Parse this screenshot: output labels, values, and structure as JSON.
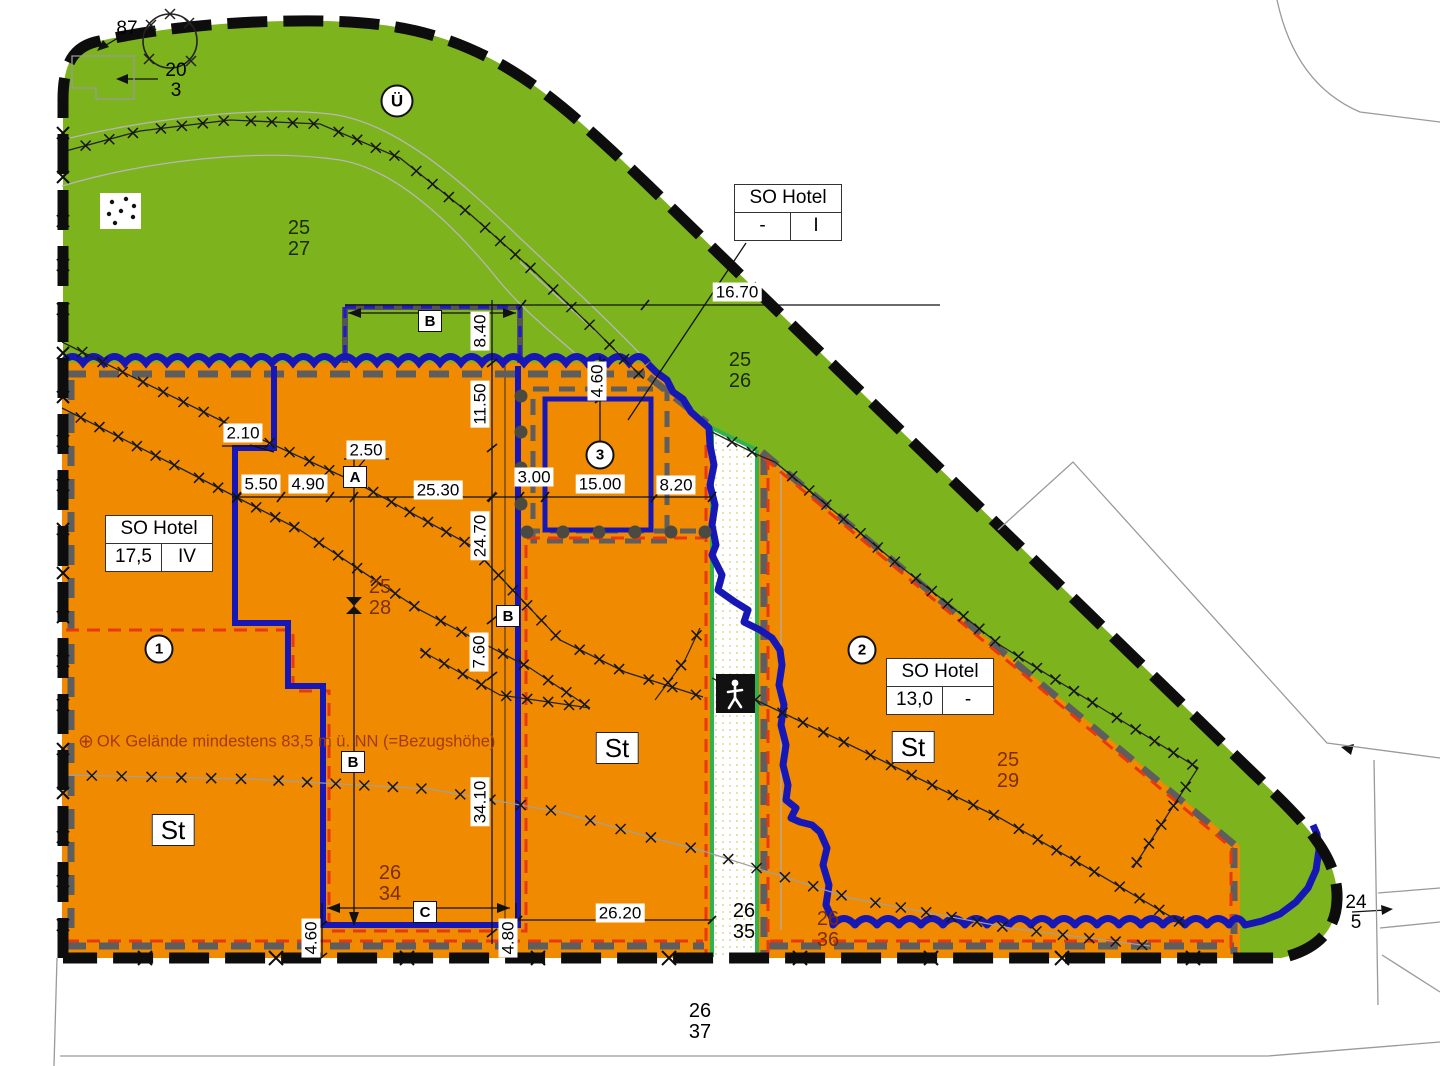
{
  "plan": {
    "type": "Bebauungsplan / zoning site plan",
    "note": {
      "symbol": "⊕",
      "text": "OK Gelände mindestens 83,5 m ü. NN (=Bezugshöhe)"
    },
    "colors": {
      "open_space_green": "#7db31c",
      "building_land_orange": "#f08a00",
      "scope_line_blue": "#1717b5",
      "building_line_red": "#e8380f",
      "boundary_black": "#0d0d0d",
      "dashed_gray": "#5e5e5e",
      "footpath_edge_green": "#2eb34f"
    }
  },
  "tables": {
    "hotel_top": {
      "title": "SO Hotel",
      "left": "-",
      "right": "I"
    },
    "hotel_left": {
      "title": "SO Hotel",
      "left": "17,5",
      "right": "IV"
    },
    "hotel_right": {
      "title": "SO Hotel",
      "left": "13,0",
      "right": "-"
    }
  },
  "dims": {
    "d16_70": "16.70",
    "d8_40": "8.40",
    "d11_50": "11.50",
    "d4_60a": "4.60",
    "d2_10": "2.10",
    "d2_50": "2.50",
    "d5_50": "5.50",
    "d4_90": "4.90",
    "d25_30": "25.30",
    "d3_00": "3.00",
    "d15_00": "15.00",
    "d8_20": "8.20",
    "d24_70": "24.70",
    "d7_60": "7.60",
    "d34_10": "34.10",
    "d26_20": "26.20",
    "d4_60b": "4.60",
    "d4_80": "4.80"
  },
  "markers": {
    "a": "A",
    "b": "B",
    "c": "C",
    "st": "St",
    "circle1": "1",
    "circle2": "2",
    "circle3": "3",
    "ue": "Ü"
  },
  "parcels": {
    "p87": {
      "top": "87"
    },
    "p20_3": {
      "top": "20",
      "bottom": "3"
    },
    "p25_27": {
      "top": "25",
      "bottom": "27"
    },
    "p25_26": {
      "top": "25",
      "bottom": "26"
    },
    "p25_28": {
      "top": "25",
      "bottom": "28"
    },
    "p25_29": {
      "top": "25",
      "bottom": "29"
    },
    "p26_34": {
      "top": "26",
      "bottom": "34"
    },
    "p26_35": {
      "top": "26",
      "bottom": "35"
    },
    "p26_36": {
      "top": "26",
      "bottom": "36"
    },
    "p26_37": {
      "top": "26",
      "bottom": "37"
    },
    "p24_5": {
      "top": "24",
      "bottom": "5"
    }
  }
}
